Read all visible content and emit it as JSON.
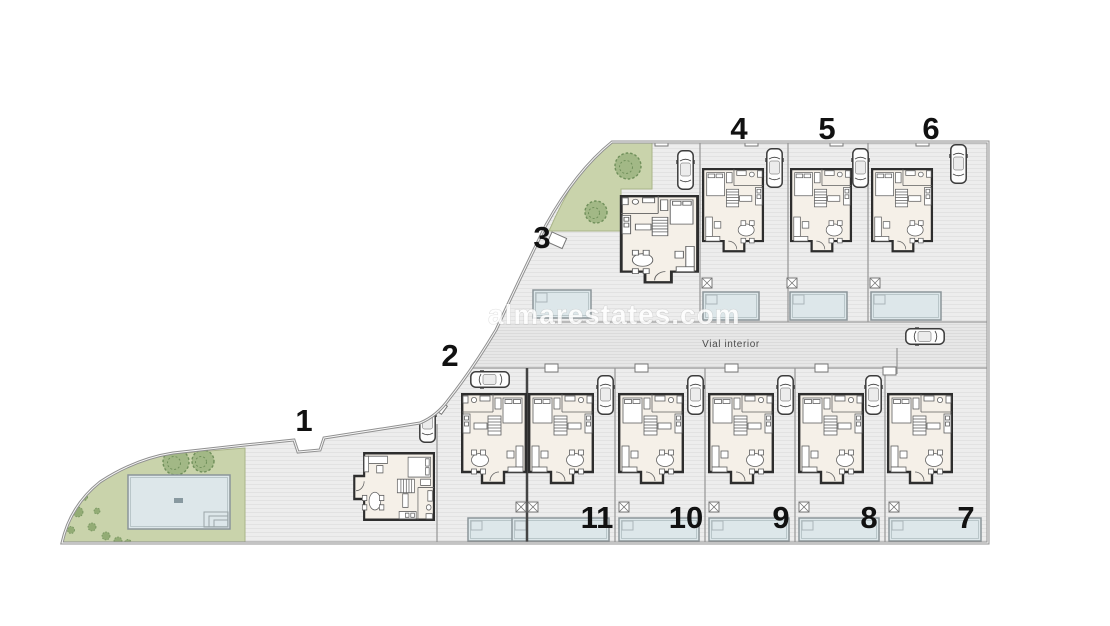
{
  "site": {
    "watermark_text": "almarestates.com",
    "road_label": "Vial interior",
    "plots": [
      {
        "number": "1"
      },
      {
        "number": "2"
      },
      {
        "number": "3"
      },
      {
        "number": "4"
      },
      {
        "number": "5"
      },
      {
        "number": "6"
      },
      {
        "number": "7"
      },
      {
        "number": "8"
      },
      {
        "number": "9"
      },
      {
        "number": "10"
      },
      {
        "number": "11"
      }
    ],
    "palette": {
      "background": "#ffffff",
      "paving": "#ededed",
      "paving_stripe": "#e2e2e2",
      "road": "#e7e7e7",
      "road_stripe": "#dbdbdb",
      "green": "#c9d3ab",
      "green_edge": "#a9b488",
      "tree": "#9bb37f",
      "tree_edge": "#6f8f5a",
      "pool": "#dde7ea",
      "pool_edge": "#8b9599",
      "wall": "#2e2e2e",
      "floor": "#f5f0e8",
      "boundary": "#909090",
      "divider": "#9b9b9b",
      "label_color": "#111111"
    }
  }
}
